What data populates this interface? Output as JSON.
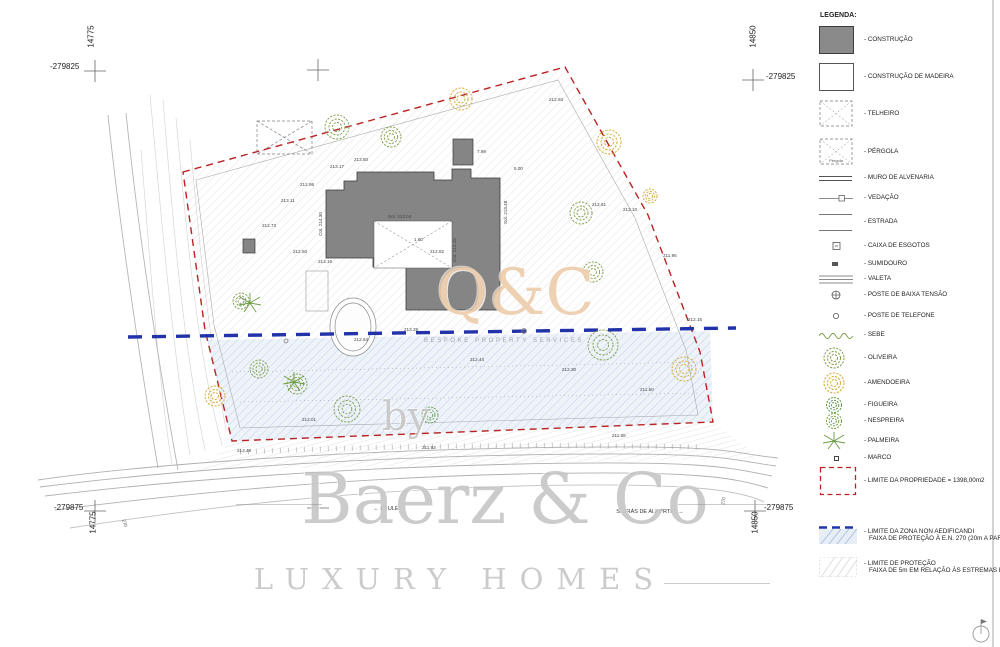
{
  "colors": {
    "boundary_red": "#bb2222",
    "zone_blue": "#2233aa",
    "zone_blue_hatch": "#9ab4d8",
    "construction_gray": "#858585",
    "olive_green": "#7d9c44",
    "almond_yellow": "#d4af3f",
    "fig_green": "#5f9a4a",
    "watermark_gray": "#8c8c8c",
    "qc_orange": "#e0ac74"
  },
  "corners": {
    "top_left": {
      "x_label": "-279825",
      "y_label": "14775"
    },
    "top_right": {
      "x_label": "-279825",
      "y_label": "14850"
    },
    "bottom_left": {
      "x_label": "-279875",
      "y_label": "14775"
    },
    "bottom_right": {
      "x_label": "-279875",
      "y_label": "14850"
    }
  },
  "legend": {
    "title": "LEGENDA:",
    "items": [
      {
        "label": "- CONSTRUÇÃO"
      },
      {
        "label": "- CONSTRUÇÃO DE MADEIRA"
      },
      {
        "label": "- TELHEIRO"
      },
      {
        "label": "- PÉRGOLA",
        "swatch_text": "Pérgola"
      },
      {
        "label": "- MURO DE ALVENARIA"
      },
      {
        "label": "- VEDAÇÃO"
      },
      {
        "label": "- ESTRADA"
      },
      {
        "label": "- CAIXA DE ESGOTOS"
      },
      {
        "label": "- SUMIDOURO"
      },
      {
        "label": "- VALETA"
      },
      {
        "label": "- POSTE DE BAIXA TENSÃO"
      },
      {
        "label": "- POSTE DE TELEFONE"
      },
      {
        "label": "- SEBE"
      },
      {
        "label": "- OLIVEIRA"
      },
      {
        "label": "- AMENDOEIRA"
      },
      {
        "label": "- FIGUEIRA"
      },
      {
        "label": "- NESPREIRA"
      },
      {
        "label": "- PALMEIRA"
      },
      {
        "label": "- MARCO"
      },
      {
        "label": "- LIMITE DA PROPRIEDADE = 1398,00m2"
      },
      {
        "label": "- LIMITE DA ZONA NON AEDIFICANDI",
        "label2": "FAIXA DE PROTEÇÃO À E.N. 270 (20m A PARTIR DO EIXO DA VIA)"
      },
      {
        "label": "- LIMITE DE PROTEÇÃO",
        "label2": "FAIXA DE 5m EM RELAÇÃO ÀS ESTREMAS DA PROPRIEDADE"
      }
    ]
  },
  "roads": {
    "left_label": "← LOULÉ",
    "right_label": "S. BRÁS DE ALPORTEL →",
    "road_number": "270"
  },
  "watermarks": {
    "qc": "Q&C",
    "qc_sub": "BESPOKE PROPERTY SERVICES",
    "by": "by",
    "brand": "Baerz & Co",
    "tagline": "LUXURY HOMES"
  },
  "plan": {
    "labels": [
      {
        "t": "213.17"
      },
      {
        "t": "213.50"
      },
      {
        "t": "212.95"
      },
      {
        "t": "213.11"
      },
      {
        "t": "212.73"
      },
      {
        "t": "212.50"
      },
      {
        "t": "213.16"
      },
      {
        "t": "Sol. 213.04"
      },
      {
        "t": "1.60"
      },
      {
        "t": "212.82"
      },
      {
        "t": "Cot. 214.25"
      },
      {
        "t": "Sol. 213.48"
      },
      {
        "t": "5.00"
      },
      {
        "t": "7.98"
      },
      {
        "t": "212.93"
      },
      {
        "t": "212.61"
      },
      {
        "t": "213.10"
      },
      {
        "t": "211.96"
      },
      {
        "t": "212.15"
      },
      {
        "t": "212.54"
      },
      {
        "t": "213.25"
      },
      {
        "t": "212.44"
      },
      {
        "t": "212.30"
      },
      {
        "t": "211.50"
      },
      {
        "t": "212.01"
      },
      {
        "t": "Cot. 214.30"
      },
      {
        "t": "213.48"
      },
      {
        "t": "211.93"
      },
      {
        "t": "211.58"
      }
    ]
  }
}
